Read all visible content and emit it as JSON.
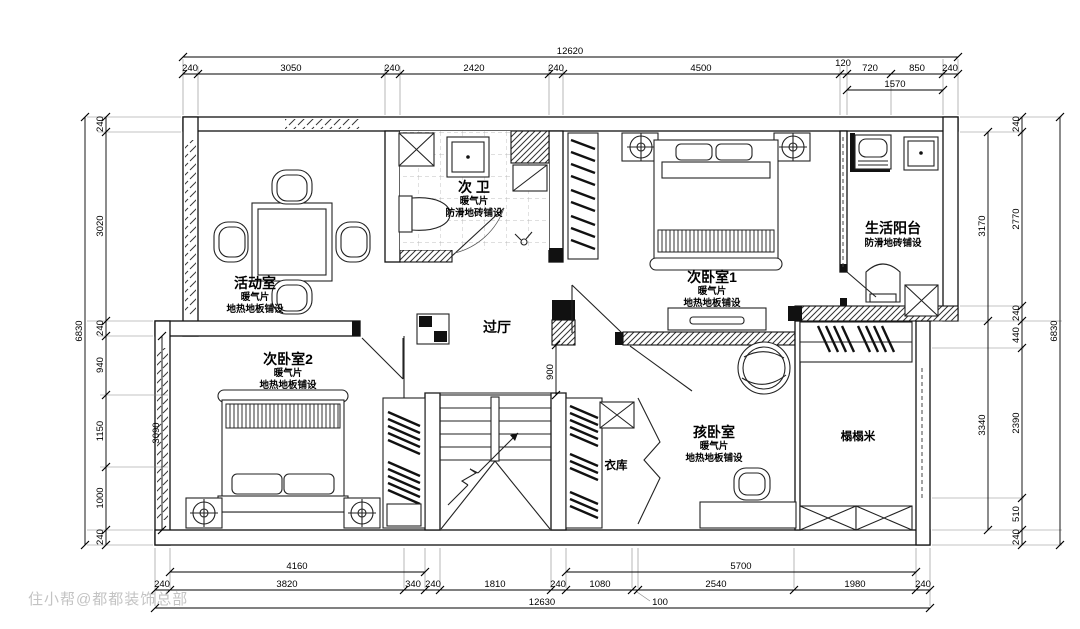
{
  "watermark": "住小帮@都都装饰总部",
  "rooms": {
    "activity": {
      "name": "活动室",
      "heat": "暖气片",
      "floor": "地热地板铺设"
    },
    "bath": {
      "name": "次 卫",
      "heat": "暖气片",
      "floor": "防滑地砖铺设"
    },
    "bedroom1": {
      "name": "次卧室1",
      "heat": "暖气片",
      "floor": "地热地板铺设"
    },
    "balcony": {
      "name": "生活阳台",
      "floor": "防滑地砖铺设"
    },
    "hall": {
      "name": "过厅"
    },
    "bedroom2": {
      "name": "次卧室2",
      "heat": "暖气片",
      "floor": "地热地板铺设"
    },
    "closet": {
      "name": "衣库"
    },
    "kidroom": {
      "name": "孩卧室",
      "heat": "暖气片",
      "floor": "地热地板铺设"
    },
    "tatami": {
      "name": "榻榻米"
    }
  },
  "dims": {
    "top": {
      "total": "12620",
      "sub": "1570",
      "segments": [
        "240",
        "3050",
        "240",
        "2420",
        "240",
        "4500",
        "120",
        "720",
        "850",
        "240"
      ]
    },
    "bottom": {
      "total": "12630",
      "gap": "100",
      "sub_left": "4160",
      "sub_right": "5700",
      "segments": [
        "240",
        "3820",
        "340",
        "240",
        "1810",
        "240",
        "1080",
        "2540",
        "1980",
        "240"
      ]
    },
    "left": {
      "total": "6830",
      "sub": "3090",
      "segments": [
        "240",
        "3020",
        "240",
        "940",
        "1150",
        "1000",
        "240"
      ]
    },
    "right": {
      "total": "6830",
      "sub_top": "3170",
      "sub_bottom": "3340",
      "segments": [
        "240",
        "2770",
        "240",
        "440",
        "2390",
        "510",
        "240"
      ]
    },
    "interior": {
      "hall_opening": "900"
    }
  }
}
